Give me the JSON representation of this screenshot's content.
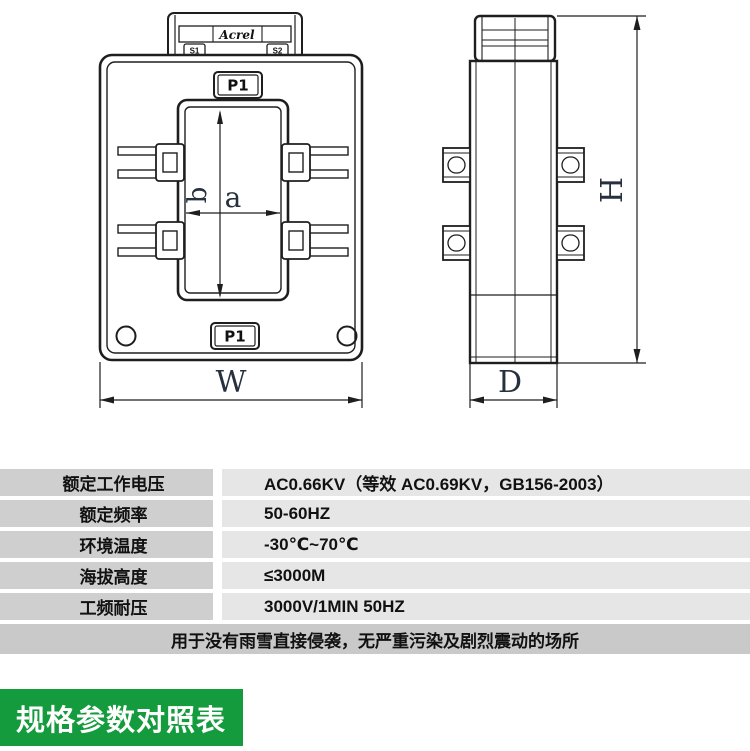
{
  "drawing": {
    "front_view": {
      "brand_logo": "Acrel",
      "terminal_left_label": "S1",
      "terminal_right_label": "S2",
      "top_marking": "P1",
      "bottom_marking": "P1",
      "dim_window_width_label": "a",
      "dim_window_height_label": "b",
      "dim_overall_width_label": "W"
    },
    "side_view": {
      "dim_overall_height_label": "H",
      "dim_overall_depth_label": "D"
    },
    "line_color": "#1e1e1e",
    "dim_label_color": "#26303f"
  },
  "spec_table": {
    "rows": [
      {
        "label": "额定工作电压",
        "value": "AC0.66KV（等效 AC0.69KV，GB156-2003）"
      },
      {
        "label": "额定频率",
        "value": "50-60HZ"
      },
      {
        "label": "环境温度",
        "value": "-30℃~70℃"
      },
      {
        "label": "海拔高度",
        "value": "≤3000M"
      },
      {
        "label": "工频耐压",
        "value": "3000V/1MIN 50HZ"
      }
    ],
    "note": "用于没有雨雪直接侵袭，无严重污染及剧烈震动的场所",
    "label_bg": "#cfcfcf",
    "value_bg": "#e6e6e6",
    "note_bg": "#c9c9c9"
  },
  "section_title": {
    "text": "规格参数对照表",
    "bg": "#149b3d",
    "color": "#ffffff"
  }
}
